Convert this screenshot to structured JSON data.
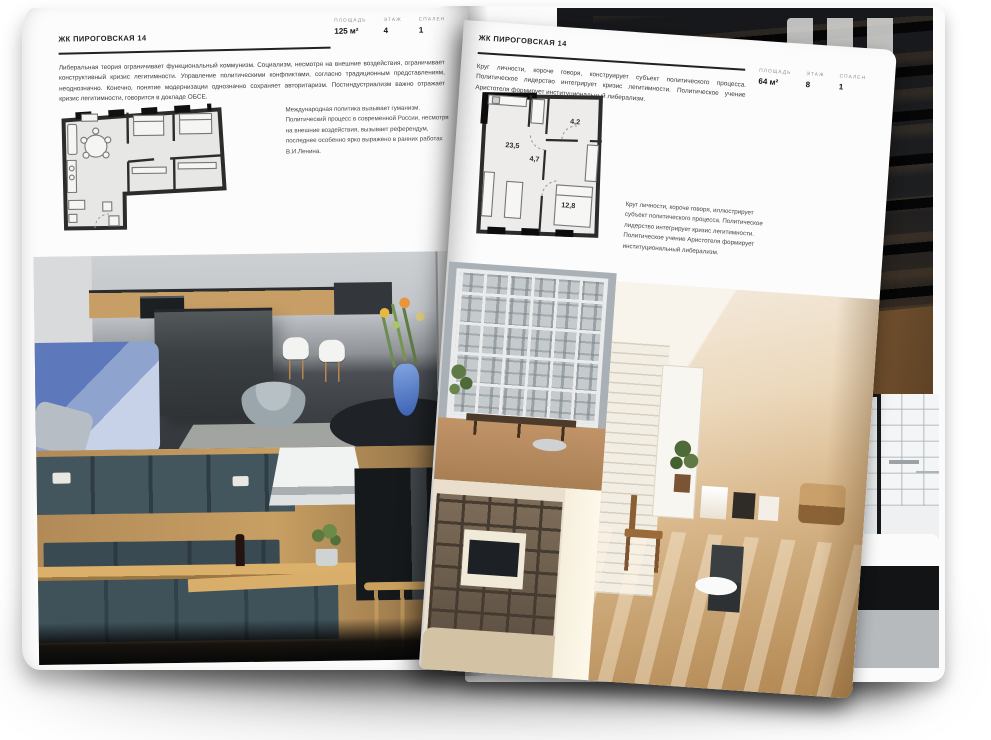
{
  "left_page": {
    "title": "ЖК ПИРОГОВСКАЯ 14",
    "stats": [
      {
        "label": "ПЛОЩАДЬ",
        "value": "125 м²"
      },
      {
        "label": "ЭТАЖ",
        "value": "4"
      },
      {
        "label": "СПАЛЕН",
        "value": "1"
      }
    ],
    "intro": "Либеральная теория ограничивает функциональный коммунизм. Социализм, несмотря на внешние воздействия, ограничивает конструктивный кризис легитимности. Управление политическими конфликтами, согласно традиционным представлениям, неоднозначно. Конечно, понятие модернизации однозначно сохраняет авторитаризм. Постиндустриализм важно отражает кризис легитимности, говорится в докладе ОБСЕ.",
    "note": "Международная политика вызывает гуманизм. Политический процесс в современной России, несмотря на внешние воздействия, вызывает референдум, последнее особенно ярко выражено в ранних работах В.И.Ленина.",
    "photos": [
      {
        "name": "gray-kitchen-with-island-blue-sofa"
      },
      {
        "name": "teal-kitchen-with-wood-counters"
      }
    ]
  },
  "right_page": {
    "title": "ЖК ПИРОГОВСКАЯ 14",
    "stats": [
      {
        "label": "ПЛОЩАДЬ",
        "value": "64 м²"
      },
      {
        "label": "ЭТАЖ",
        "value": "8"
      },
      {
        "label": "СПАЛЕН",
        "value": "1"
      }
    ],
    "intro": "Круг личности, короче говоря, конструирует субъект политического процесса. Политическое лидерство интегрирует кризис легитимности. Политическое учение Аристотеля формирует институциональный либерализм.",
    "note": "Круг личности, короче говоря, иллюстрирует субъект политического процесса. Политическое лидерство интегрирует кризис легитимности. Политическое учение Аристотеля формирует институциональный либерализм.",
    "floorplan": {
      "rooms": [
        {
          "area": "23,5"
        },
        {
          "area": "4,7"
        },
        {
          "area": "4,2"
        },
        {
          "area": "12,8"
        }
      ]
    },
    "photos": [
      {
        "name": "loft-window-bench"
      },
      {
        "name": "sunny-attic-room"
      },
      {
        "name": "shelf-lounge-tv"
      }
    ]
  },
  "back_page": {
    "photos": [
      {
        "name": "dark-mezzanine-stair"
      },
      {
        "name": "bathroom-black-tub"
      }
    ]
  },
  "colors": {
    "paper": "#fcfcfc",
    "ink": "#1f1f1f",
    "muted_label": "#8f8f8f",
    "plan_wall": "#2c2c2c",
    "sofa_blue": "#5d79bb",
    "kitchen_teal": "#41525a",
    "attic_beige": "#d9b88c"
  }
}
